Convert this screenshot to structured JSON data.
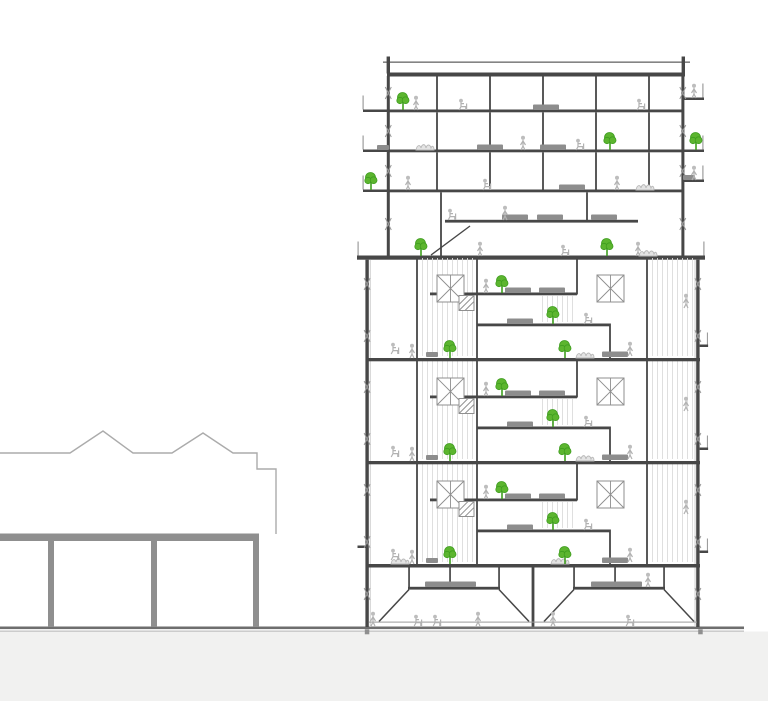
{
  "drawing": {
    "type": "architectural-building-section",
    "subject": "residential tower section with split-level floors beside low neighboring building",
    "colors": {
      "background": "#ffffff",
      "earth": "#f1f1f0",
      "line_dark": "#474747",
      "line_medium": "#8f8f8f",
      "line_light": "#ababab",
      "ground_line": "#6e6e6e",
      "panel_stroke": "#8f8f8f",
      "figure": "#b2b2b2",
      "furniture": "#8d8d8d",
      "tree_green": "#5cb52f",
      "tree_dark": "#3f9e1f"
    },
    "trees": [
      {
        "x": 403,
        "y": 110
      },
      {
        "x": 610,
        "y": 150
      },
      {
        "x": 696,
        "y": 150
      },
      {
        "x": 371,
        "y": 190
      },
      {
        "x": 421,
        "y": 256
      },
      {
        "x": 607,
        "y": 256
      },
      {
        "x": 502,
        "y": 293
      },
      {
        "x": 553,
        "y": 324
      },
      {
        "x": 450,
        "y": 358
      },
      {
        "x": 565,
        "y": 358
      },
      {
        "x": 502,
        "y": 396
      },
      {
        "x": 553,
        "y": 427
      },
      {
        "x": 450,
        "y": 461
      },
      {
        "x": 565,
        "y": 461
      },
      {
        "x": 502,
        "y": 499
      },
      {
        "x": 553,
        "y": 530
      },
      {
        "x": 450,
        "y": 564
      },
      {
        "x": 565,
        "y": 564
      }
    ],
    "figures_standing": [
      {
        "x": 416,
        "y": 110
      },
      {
        "x": 694,
        "y": 98
      },
      {
        "x": 523,
        "y": 150
      },
      {
        "x": 408,
        "y": 190
      },
      {
        "x": 617,
        "y": 190
      },
      {
        "x": 694,
        "y": 180
      },
      {
        "x": 505,
        "y": 220
      },
      {
        "x": 480,
        "y": 256
      },
      {
        "x": 638,
        "y": 256
      },
      {
        "x": 486,
        "y": 293
      },
      {
        "x": 686,
        "y": 308
      },
      {
        "x": 412,
        "y": 358
      },
      {
        "x": 630,
        "y": 356
      },
      {
        "x": 486,
        "y": 396
      },
      {
        "x": 686,
        "y": 411
      },
      {
        "x": 412,
        "y": 461
      },
      {
        "x": 630,
        "y": 459
      },
      {
        "x": 486,
        "y": 499
      },
      {
        "x": 686,
        "y": 514
      },
      {
        "x": 412,
        "y": 564
      },
      {
        "x": 630,
        "y": 562
      },
      {
        "x": 478,
        "y": 626
      },
      {
        "x": 553,
        "y": 626
      },
      {
        "x": 648,
        "y": 587
      },
      {
        "x": 373,
        "y": 626
      }
    ],
    "figures_sitting": [
      {
        "x": 463,
        "y": 110
      },
      {
        "x": 641,
        "y": 110
      },
      {
        "x": 580,
        "y": 150
      },
      {
        "x": 487,
        "y": 190
      },
      {
        "x": 452,
        "y": 220
      },
      {
        "x": 565,
        "y": 256
      },
      {
        "x": 588,
        "y": 324
      },
      {
        "x": 395,
        "y": 354
      },
      {
        "x": 588,
        "y": 427
      },
      {
        "x": 395,
        "y": 457
      },
      {
        "x": 588,
        "y": 530
      },
      {
        "x": 395,
        "y": 560
      },
      {
        "x": 418,
        "y": 626
      },
      {
        "x": 437,
        "y": 626
      },
      {
        "x": 630,
        "y": 626
      }
    ],
    "furniture": [
      {
        "x": 546,
        "y": 110
      },
      {
        "x": 383,
        "y": 150,
        "v": "sm"
      },
      {
        "x": 490,
        "y": 150
      },
      {
        "x": 553,
        "y": 150
      },
      {
        "x": 572,
        "y": 190
      },
      {
        "x": 689,
        "y": 180,
        "v": "sm"
      },
      {
        "x": 515,
        "y": 220
      },
      {
        "x": 550,
        "y": 220
      },
      {
        "x": 604,
        "y": 220
      },
      {
        "x": 518,
        "y": 293
      },
      {
        "x": 552,
        "y": 293
      },
      {
        "x": 520,
        "y": 324
      },
      {
        "x": 615,
        "y": 357
      },
      {
        "x": 432,
        "y": 357,
        "v": "sm"
      },
      {
        "x": 518,
        "y": 396
      },
      {
        "x": 552,
        "y": 396
      },
      {
        "x": 520,
        "y": 427
      },
      {
        "x": 615,
        "y": 460
      },
      {
        "x": 432,
        "y": 460,
        "v": "sm"
      },
      {
        "x": 518,
        "y": 499
      },
      {
        "x": 552,
        "y": 499
      },
      {
        "x": 520,
        "y": 530
      },
      {
        "x": 615,
        "y": 563
      },
      {
        "x": 432,
        "y": 563,
        "v": "sm"
      },
      {
        "x": 438,
        "y": 587
      },
      {
        "x": 463,
        "y": 587
      },
      {
        "x": 604,
        "y": 587
      },
      {
        "x": 629,
        "y": 587
      }
    ],
    "bushes": [
      {
        "x": 425,
        "y": 150
      },
      {
        "x": 645,
        "y": 190
      },
      {
        "x": 648,
        "y": 256
      },
      {
        "x": 585,
        "y": 358
      },
      {
        "x": 585,
        "y": 461
      },
      {
        "x": 400,
        "y": 564
      },
      {
        "x": 560,
        "y": 564
      }
    ]
  }
}
